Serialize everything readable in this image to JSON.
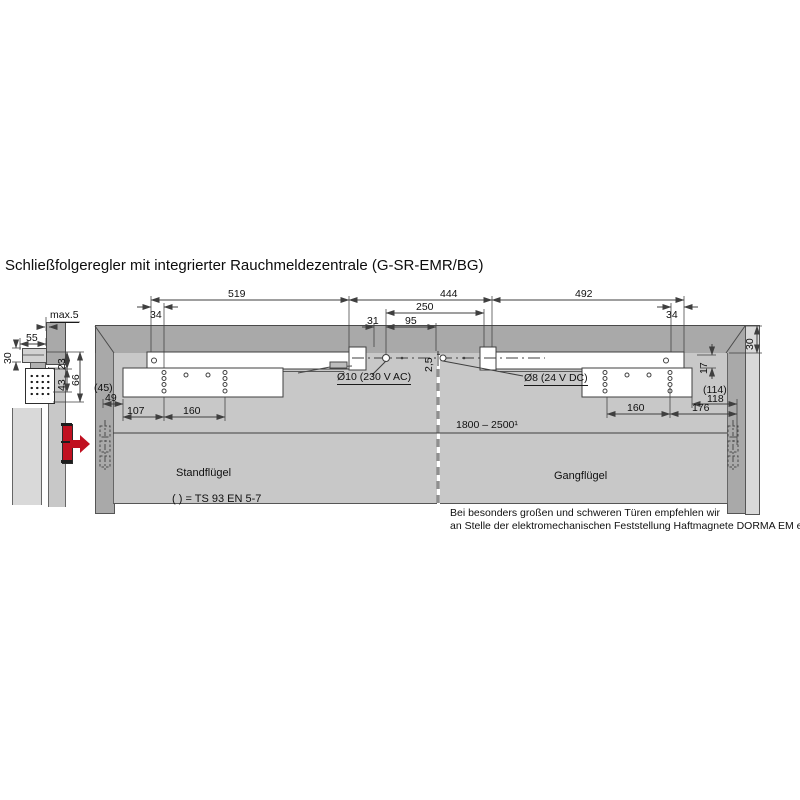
{
  "title": "Schließfolgeregler mit integrierter Rauchmeldezentrale (G-SR-EMR/BG)",
  "side_view": {
    "max5": "max.5",
    "d55": "55",
    "d30": "30",
    "d23": "23",
    "d43": "43",
    "d66": "66"
  },
  "top_dims": {
    "d519": "519",
    "d444": "444",
    "d492": "492",
    "d34_left": "34",
    "d34_right": "34",
    "d250": "250",
    "d31": "31",
    "d95": "95",
    "d2_5": "2,5"
  },
  "drill_labels": {
    "ac": "Ø10 (230 V AC)",
    "dc": "Ø8 (24 V DC)"
  },
  "left_plate_dims": {
    "alt": "(45)",
    "d49": "49",
    "d107": "107",
    "d160": "160"
  },
  "right_plate_dims": {
    "alt": "(114)",
    "d118": "118",
    "d160": "160",
    "d176": "176",
    "d17": "17",
    "d30": "30"
  },
  "door": {
    "width_range": "1800 – 2500¹",
    "left_leaf": "Standflügel",
    "right_leaf": "Gangflügel",
    "legend": "( ) = TS 93 EN 5-7"
  },
  "note": {
    "line1": "Bei besonders großen und schweren Türen empfehlen wir",
    "line2": "an Stelle der elektromechanischen Feststellung Haftmagnete DORMA EM einzusetzen."
  },
  "colors": {
    "wall": "#a9a9a9",
    "door_leaf": "#c8c8c8",
    "outer_wall": "#d9d9d9",
    "line": "#3f3f3f",
    "accent_red": "#c01020"
  }
}
